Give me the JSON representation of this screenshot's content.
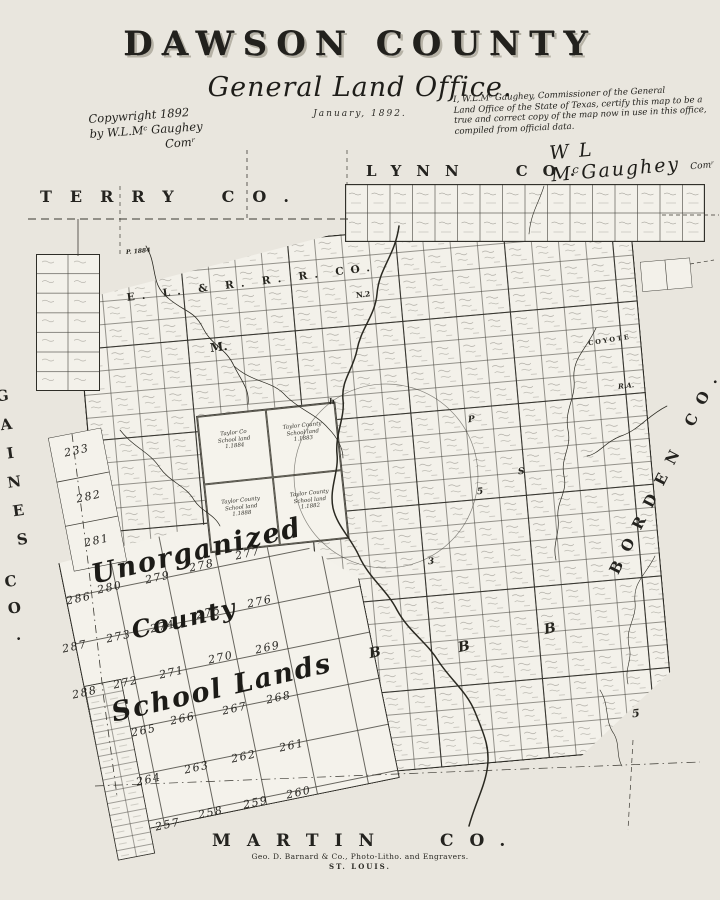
{
  "colors": {
    "paper": "#e9e6de",
    "map_fill": "#f3f1ea",
    "ink": "#23221e"
  },
  "title": {
    "main": "DAWSON COUNTY",
    "sub": "General Land Office.",
    "date": "January, 1892."
  },
  "copyright": {
    "line1": "Copywright 1892",
    "line2": "by W.L.Mᶜ Gaughey",
    "line3": "Comʳ"
  },
  "certification": {
    "lines": [
      "I, W.L.Mᶜ Gaughey, Commissioner of the General",
      "Land Office of the State of Texas, certify this map to be a",
      "true and correct copy of the map now in use in this office,",
      "compiled from official data."
    ],
    "signature": "W L MᶜGaughey",
    "signature_title": "Comʳ"
  },
  "counties": {
    "terry": {
      "name": "TERRY",
      "suffix": "CO."
    },
    "lynn": {
      "name": "LYNN",
      "suffix": "CO."
    },
    "gaines": {
      "name": "GAINES",
      "suffix": "CO."
    },
    "borden": {
      "label": "BORDEN CO."
    },
    "martin": {
      "name": "MARTIN",
      "suffix": "CO."
    }
  },
  "map": {
    "railroad_label": "E. L. & R. R. R. CO.",
    "script_labels": {
      "l1": "Unorganized",
      "l2": "County",
      "l3": "School Lands"
    },
    "school_numbers": [
      {
        "n": "233",
        "x": 64,
        "y": 444
      },
      {
        "n": "282",
        "x": 76,
        "y": 490
      },
      {
        "n": "281",
        "x": 84,
        "y": 534
      },
      {
        "n": "286",
        "x": 66,
        "y": 592
      },
      {
        "n": "287",
        "x": 62,
        "y": 640
      },
      {
        "n": "288",
        "x": 72,
        "y": 686
      },
      {
        "n": "280",
        "x": 97,
        "y": 581
      },
      {
        "n": "279",
        "x": 145,
        "y": 571
      },
      {
        "n": "278",
        "x": 189,
        "y": 559
      },
      {
        "n": "277",
        "x": 235,
        "y": 547
      },
      {
        "n": "273",
        "x": 106,
        "y": 630
      },
      {
        "n": "274",
        "x": 150,
        "y": 620
      },
      {
        "n": "275",
        "x": 196,
        "y": 606
      },
      {
        "n": "276",
        "x": 247,
        "y": 595
      },
      {
        "n": "272",
        "x": 113,
        "y": 676
      },
      {
        "n": "271",
        "x": 159,
        "y": 666
      },
      {
        "n": "270",
        "x": 208,
        "y": 651
      },
      {
        "n": "269",
        "x": 255,
        "y": 641
      },
      {
        "n": "265",
        "x": 131,
        "y": 724
      },
      {
        "n": "266",
        "x": 170,
        "y": 712
      },
      {
        "n": "267",
        "x": 222,
        "y": 702
      },
      {
        "n": "268",
        "x": 266,
        "y": 691
      },
      {
        "n": "264",
        "x": 136,
        "y": 773
      },
      {
        "n": "263",
        "x": 184,
        "y": 761
      },
      {
        "n": "262",
        "x": 231,
        "y": 750
      },
      {
        "n": "261",
        "x": 279,
        "y": 739
      },
      {
        "n": "257",
        "x": 155,
        "y": 818
      },
      {
        "n": "258",
        "x": 198,
        "y": 806
      },
      {
        "n": "259",
        "x": 243,
        "y": 796
      },
      {
        "n": "260",
        "x": 286,
        "y": 786
      }
    ],
    "letters": [
      {
        "t": "P. 1884",
        "x": 126,
        "y": 248,
        "s": 6,
        "r": -5,
        "i": 1
      },
      {
        "t": "N.2",
        "x": 356,
        "y": 290,
        "s": 7.5,
        "r": -6,
        "i": 0
      },
      {
        "t": "M.",
        "x": 210,
        "y": 340,
        "s": 12,
        "r": -7,
        "i": 0
      },
      {
        "t": "COYOTE",
        "x": 588,
        "y": 336,
        "s": 6.5,
        "r": -9,
        "i": 0,
        "ls": 2
      },
      {
        "t": "R.A.",
        "x": 618,
        "y": 381,
        "s": 7,
        "r": -6,
        "i": 1
      },
      {
        "t": "B",
        "x": 369,
        "y": 645,
        "s": 14,
        "r": -12,
        "i": 1
      },
      {
        "t": "B",
        "x": 458,
        "y": 639,
        "s": 14,
        "r": -12,
        "i": 1
      },
      {
        "t": "B",
        "x": 544,
        "y": 621,
        "s": 14,
        "r": -12,
        "i": 1
      },
      {
        "t": "5",
        "x": 632,
        "y": 707,
        "s": 11,
        "r": -6,
        "i": 1
      },
      {
        "t": "5",
        "x": 477,
        "y": 487,
        "s": 9,
        "r": -6,
        "i": 1
      },
      {
        "t": "3",
        "x": 428,
        "y": 557,
        "s": 9,
        "r": -6,
        "i": 1
      },
      {
        "t": "P",
        "x": 468,
        "y": 415,
        "s": 9,
        "r": -6,
        "i": 1
      },
      {
        "t": "S",
        "x": 518,
        "y": 467,
        "s": 9,
        "r": -6,
        "i": 1
      },
      {
        "t": "h",
        "x": 329,
        "y": 396,
        "s": 8,
        "r": -6,
        "i": 1
      }
    ],
    "taylor_blocks": [
      [
        "Taylor Co",
        "School land",
        "1.1884"
      ],
      [
        "Taylor County",
        "School land",
        "1.1883"
      ],
      [
        "Taylor County",
        "School land",
        "1.1888"
      ],
      [
        "Taylor County",
        "School land",
        "1.1882"
      ]
    ],
    "creeks": [
      {
        "d": "M146,246 C158,266 150,284 168,298 C184,312 194,310 203,328 C212,346 226,348 234,366 C241,380 250,390 248,404",
        "w": 0.8
      },
      {
        "d": "M234,366 C254,384 272,380 286,396 C300,410 316,414 328,428 C338,438 343,449 343,458",
        "w": 0.7
      },
      {
        "d": "M399,226 C395,256 379,268 377,294 C375,316 361,328 357,350 C353,370 341,380 343,400 C345,418 335,434 337,454 C339,472 329,488 333,508 C337,526 351,538 359,556 C369,578 387,590 397,610 C409,632 427,642 439,662 C451,680 467,692 475,712 C483,732 491,748 487,770 C484,788 475,804 469,826",
        "w": 1.5
      },
      {
        "d": "M596,328 C586,350 572,358 574,380 C576,398 564,410 568,430 C572,448 560,458 564,476 C568,492 556,502 558,518 C560,534 552,544 556,560",
        "w": 0.7
      },
      {
        "d": "M667,406 C647,416 639,430 621,436 C605,442 599,454 587,456",
        "w": 0.7
      },
      {
        "d": "M655,556 C645,576 633,582 635,602 C637,618 625,628 629,646 C633,660 624,668 628,684",
        "w": 0.6
      },
      {
        "d": "M544,186 C539,203 531,212 529,234",
        "w": 0.6
      },
      {
        "d": "M600,690 C610,706 604,720 614,734 C620,744 616,756 622,766",
        "w": 0.6
      },
      {
        "d": "M120,430 C134,448 150,452 160,468 C170,482 186,486 194,500 C202,512 214,514 220,526",
        "w": 0.7
      }
    ],
    "circle": {
      "cx": 386,
      "cy": 476,
      "r": 92
    },
    "boundaries": [
      {
        "d": "M28,219 H348",
        "p": "8 5",
        "w": 0.9
      },
      {
        "d": "M247,150 V219",
        "p": "4 4",
        "w": 0.8
      },
      {
        "d": "M120,186 V254",
        "p": "4 4",
        "w": 0.7
      },
      {
        "d": "M347,150 V184",
        "p": "4 4",
        "w": 0.7
      },
      {
        "d": "M78,219 V256",
        "p": "",
        "w": 0.8
      },
      {
        "d": "M72,434 L88,562 L104,700 L117,796",
        "p": "8 4 1.5 4",
        "w": 0.8
      },
      {
        "d": "M95,786 L700,762",
        "p": "9 4 1.5 4",
        "w": 0.7
      },
      {
        "d": "M633,740 L628,830",
        "p": "5 4",
        "w": 0.7
      },
      {
        "d": "M662,215 H719",
        "p": "4 3",
        "w": 0.7
      },
      {
        "d": "M690,264 L714,260",
        "p": "4 3",
        "w": 0.7
      }
    ]
  },
  "imprint": {
    "line1": "Geo. D. Barnard & Co., Photo-Litho. and Engravers.",
    "line2": "ST. LOUIS."
  }
}
